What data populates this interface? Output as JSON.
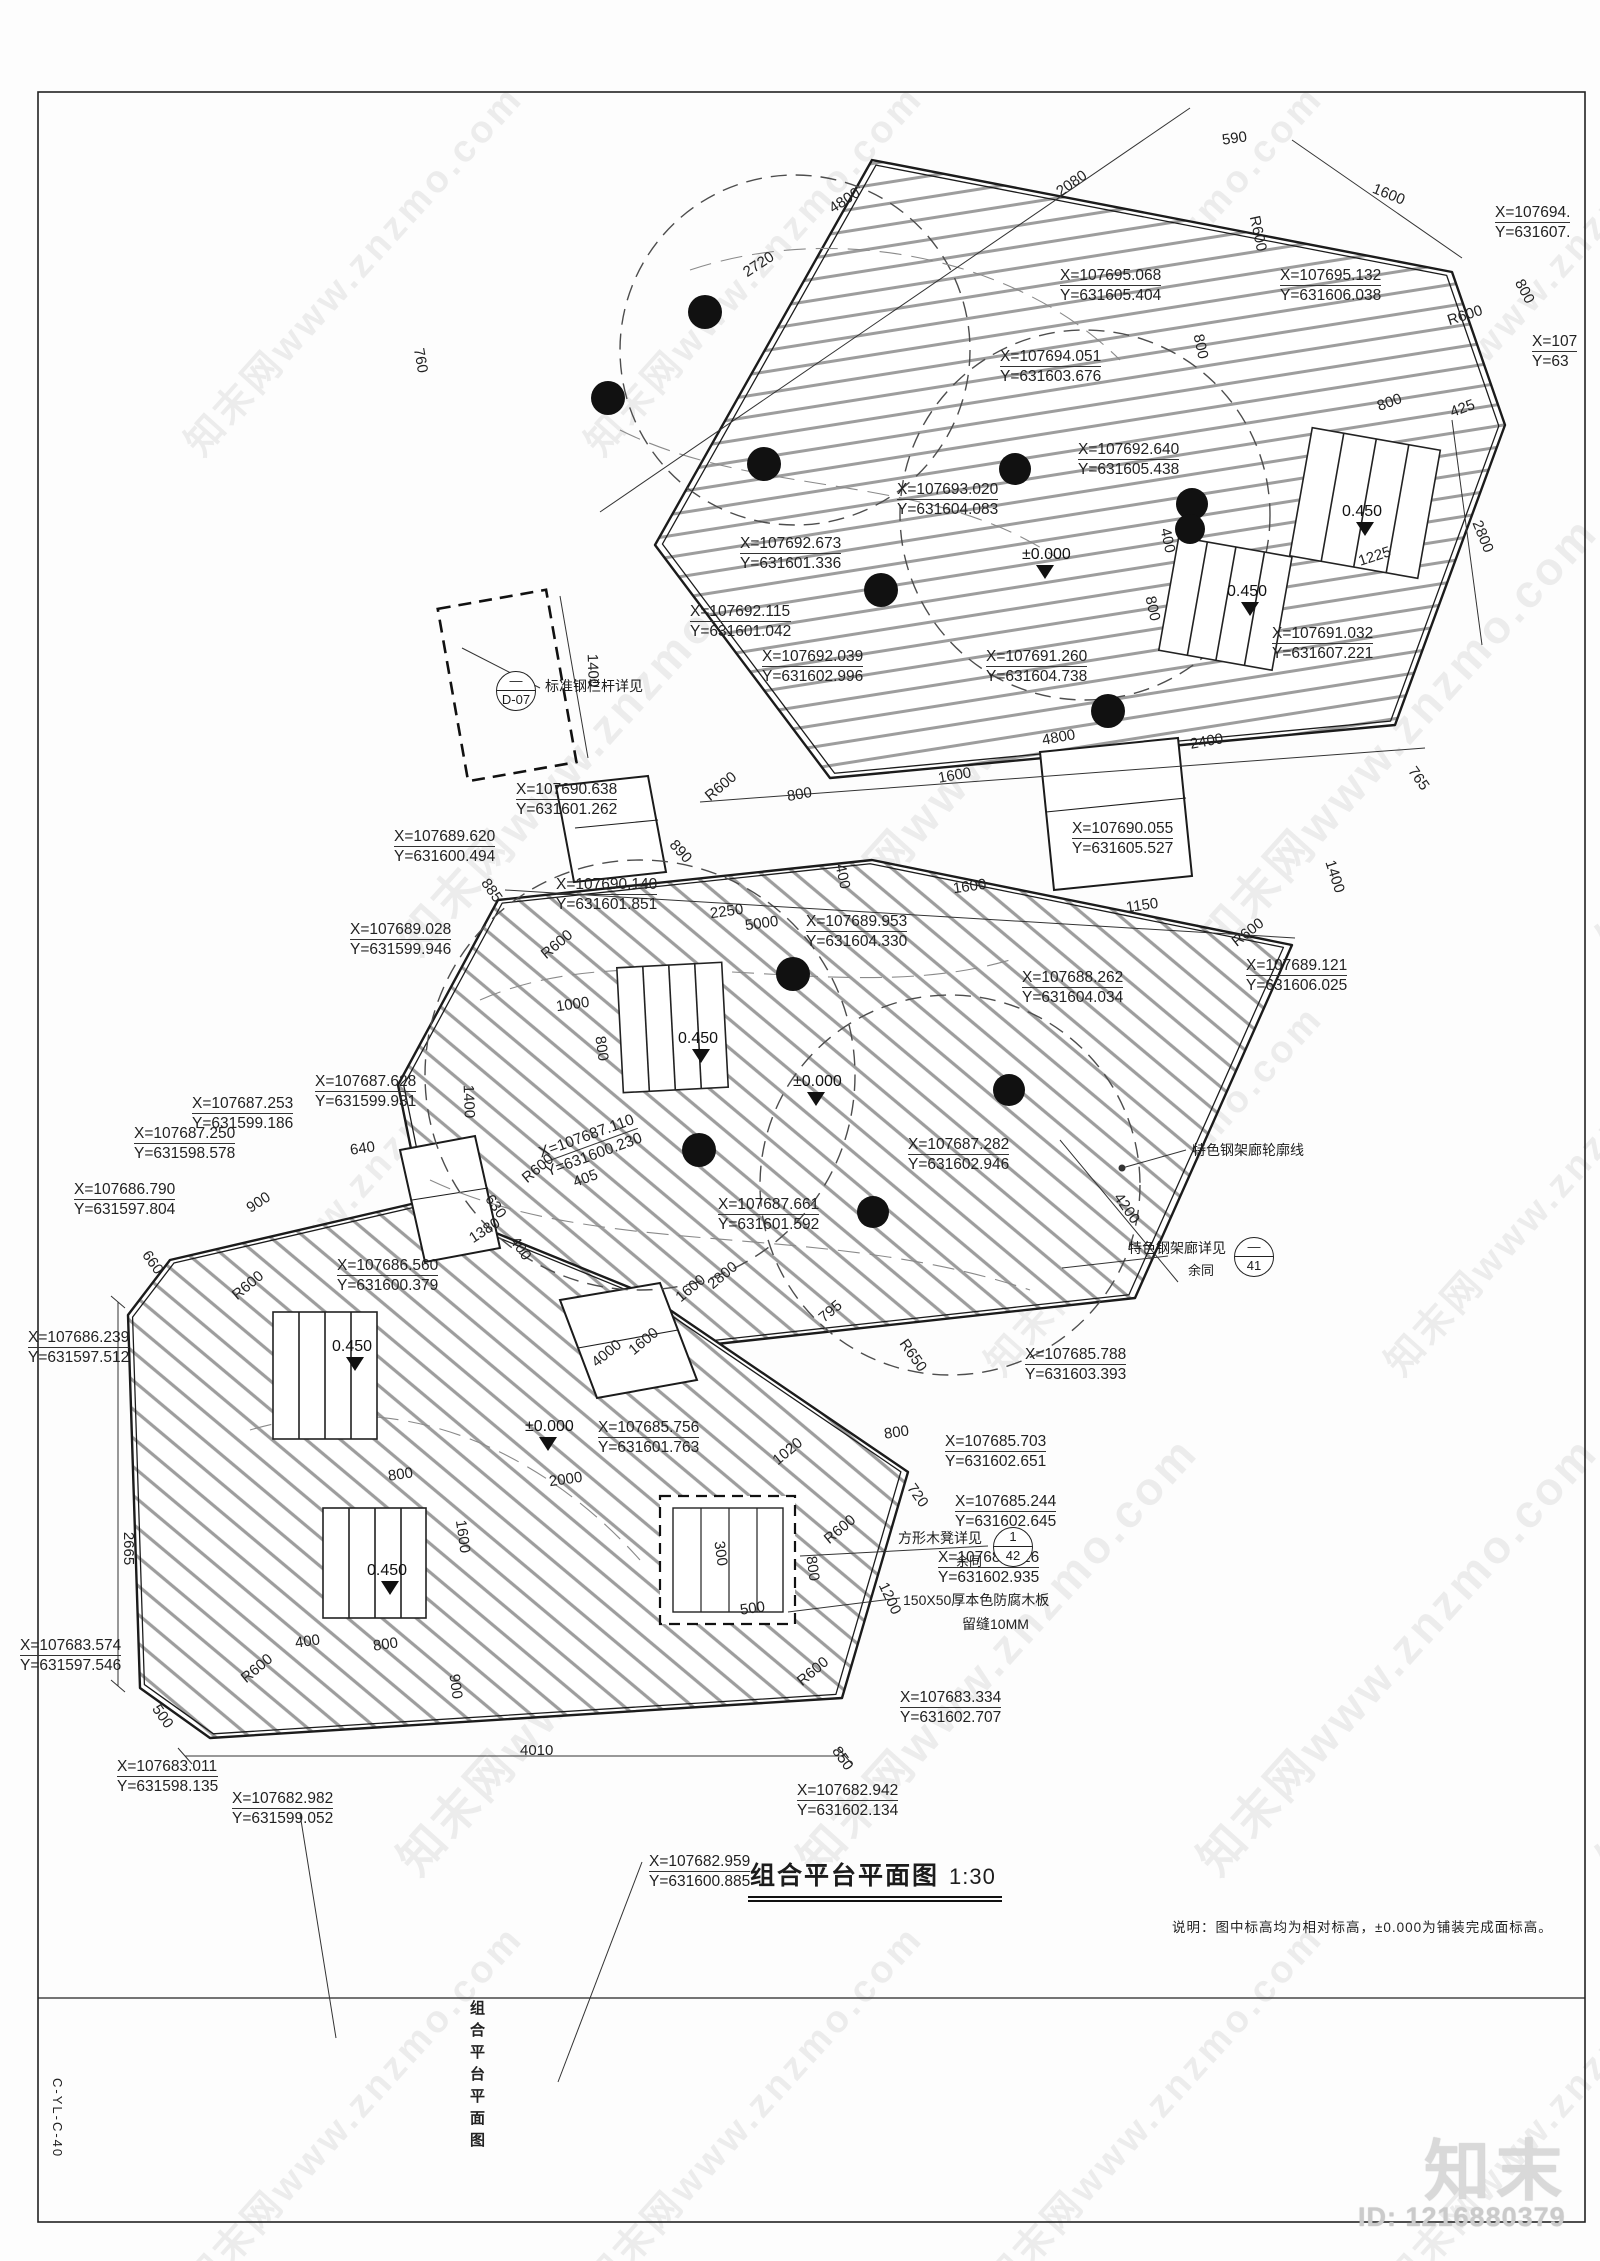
{
  "sheet": {
    "drawing_title": "组合平台平面图",
    "drawing_scale": "1:30",
    "side_title": "组合平台平面图",
    "sheet_number": "C-YL-C-40",
    "note": "说明：图中标高均为相对标高，±0.000为铺装完成面标高。"
  },
  "watermark": {
    "brand": "知末",
    "tile_text": "知末网www.znzmo.com",
    "id_text": "ID: 1216880379"
  },
  "annotations": {
    "coordinates": [
      {
        "xt": "X=107695.068",
        "yt": "Y=631605.404",
        "x": 1060,
        "y": 266
      },
      {
        "xt": "X=107695.132",
        "yt": "Y=631606.038",
        "x": 1280,
        "y": 266
      },
      {
        "xt": "X=107694.",
        "yt": "Y=631607.",
        "x": 1495,
        "y": 203
      },
      {
        "xt": "X=107694.051",
        "yt": "Y=631603.676",
        "x": 1000,
        "y": 347
      },
      {
        "xt": "X=107692.640",
        "yt": "Y=631605.438",
        "x": 1078,
        "y": 440
      },
      {
        "xt": "X=107693.020",
        "yt": "Y=631604.083",
        "x": 897,
        "y": 480
      },
      {
        "xt": "X=107692.673",
        "yt": "Y=631601.336",
        "x": 740,
        "y": 534
      },
      {
        "xt": "X=107",
        "yt": "Y=63",
        "x": 1532,
        "y": 332
      },
      {
        "xt": "X=107692.115",
        "yt": "Y=631601.042",
        "x": 690,
        "y": 602
      },
      {
        "xt": "X=107692.039",
        "yt": "Y=631602.996",
        "x": 762,
        "y": 647
      },
      {
        "xt": "X=107691.260",
        "yt": "Y=631604.738",
        "x": 986,
        "y": 647
      },
      {
        "xt": "X=107691.032",
        "yt": "Y=631607.221",
        "x": 1272,
        "y": 624
      },
      {
        "xt": "X=107690.638",
        "yt": "Y=631601.262",
        "x": 516,
        "y": 780
      },
      {
        "xt": "X=107689.620",
        "yt": "Y=631600.494",
        "x": 394,
        "y": 827
      },
      {
        "xt": "X=107690.140",
        "yt": "Y=631601.851",
        "x": 556,
        "y": 875
      },
      {
        "xt": "X=107690.055",
        "yt": "Y=631605.527",
        "x": 1072,
        "y": 819
      },
      {
        "xt": "X=107689.028",
        "yt": "Y=631599.946",
        "x": 350,
        "y": 920
      },
      {
        "xt": "X=107689.953",
        "yt": "Y=631604.330",
        "x": 806,
        "y": 912
      },
      {
        "xt": "X=107688.262",
        "yt": "Y=631604.034",
        "x": 1022,
        "y": 968
      },
      {
        "xt": "X=107689.121",
        "yt": "Y=631606.025",
        "x": 1246,
        "y": 956
      },
      {
        "xt": "X=107687.628",
        "yt": "Y=631599.931",
        "x": 315,
        "y": 1072
      },
      {
        "xt": "X=107687.253",
        "yt": "Y=631599.186",
        "x": 192,
        "y": 1094
      },
      {
        "xt": "X=107687.250",
        "yt": "Y=631598.578",
        "x": 134,
        "y": 1124
      },
      {
        "xt": "X=107686.790",
        "yt": "Y=631597.804",
        "x": 74,
        "y": 1180
      },
      {
        "xt": "X=107687.110",
        "yt": "Y=631600.230",
        "x": 540,
        "y": 1126,
        "r": -20
      },
      {
        "xt": "X=107687.282",
        "yt": "Y=631602.946",
        "x": 908,
        "y": 1135
      },
      {
        "xt": "X=107687.661",
        "yt": "Y=631601.592",
        "x": 718,
        "y": 1195
      },
      {
        "xt": "X=107686.560",
        "yt": "Y=631600.379",
        "x": 337,
        "y": 1256
      },
      {
        "xt": "X=107686.239",
        "yt": "Y=631597.512",
        "x": 28,
        "y": 1328
      },
      {
        "xt": "X=107685.756",
        "yt": "Y=631601.763",
        "x": 598,
        "y": 1418
      },
      {
        "xt": "X=107685.788",
        "yt": "Y=631603.393",
        "x": 1025,
        "y": 1345
      },
      {
        "xt": "X=107685.703",
        "yt": "Y=631602.651",
        "x": 945,
        "y": 1432
      },
      {
        "xt": "X=107685.244",
        "yt": "Y=631602.645",
        "x": 955,
        "y": 1492
      },
      {
        "xt": "X=107684.626",
        "yt": "Y=631602.935",
        "x": 938,
        "y": 1548
      },
      {
        "xt": "X=107683.574",
        "yt": "Y=631597.546",
        "x": 20,
        "y": 1636
      },
      {
        "xt": "X=107683.334",
        "yt": "Y=631602.707",
        "x": 900,
        "y": 1688
      },
      {
        "xt": "X=107682.942",
        "yt": "Y=631602.134",
        "x": 797,
        "y": 1781
      },
      {
        "xt": "X=107682.959",
        "yt": "Y=631600.885",
        "x": 649,
        "y": 1852
      },
      {
        "xt": "X=107683.011",
        "yt": "Y=631598.135",
        "x": 117,
        "y": 1757
      },
      {
        "xt": "X=107682.982",
        "yt": "Y=631599.052",
        "x": 232,
        "y": 1789
      }
    ],
    "dimensions": [
      [
        "2720",
        742,
        256,
        -33
      ],
      [
        "4800",
        828,
        192,
        -33
      ],
      [
        "2080",
        1055,
        175,
        -35
      ],
      [
        "590",
        1222,
        130,
        -8
      ],
      [
        "1600",
        1372,
        186,
        22
      ],
      [
        "800",
        1512,
        283,
        62
      ],
      [
        "R600",
        1447,
        307,
        -18
      ],
      [
        "425",
        1450,
        400,
        -20
      ],
      [
        "800",
        1377,
        394,
        -20
      ],
      [
        "R600",
        1240,
        225,
        78
      ],
      [
        "760",
        408,
        352,
        80
      ],
      [
        "800",
        1188,
        338,
        78
      ],
      [
        "400",
        1155,
        532,
        78
      ],
      [
        "800",
        1140,
        600,
        78
      ],
      [
        "1225",
        1358,
        548,
        -18
      ],
      [
        "2800",
        1466,
        528,
        68
      ],
      [
        "1400",
        576,
        662,
        88
      ],
      [
        "2400",
        1190,
        733,
        -10
      ],
      [
        "4800",
        1042,
        729,
        -10
      ],
      [
        "765",
        1406,
        770,
        55
      ],
      [
        "1400",
        1318,
        868,
        72
      ],
      [
        "1150",
        1126,
        897,
        -8
      ],
      [
        "R600",
        1230,
        924,
        -38
      ],
      [
        "800",
        787,
        786,
        -10
      ],
      [
        "1600",
        938,
        767,
        -10
      ],
      [
        "R600",
        703,
        778,
        -40
      ],
      [
        "890",
        668,
        843,
        48
      ],
      [
        "400",
        830,
        868,
        78
      ],
      [
        "885",
        479,
        882,
        55
      ],
      [
        "2250",
        710,
        903,
        -8
      ],
      [
        "1600",
        953,
        878,
        -8
      ],
      [
        "5000",
        745,
        915,
        -8
      ],
      [
        "R600",
        539,
        936,
        -40
      ],
      [
        "1000",
        556,
        996,
        -8
      ],
      [
        "800",
        589,
        1040,
        82
      ],
      [
        "1400",
        452,
        1093,
        88
      ],
      [
        "R600",
        520,
        1160,
        -40
      ],
      [
        "405",
        573,
        1170,
        -20
      ],
      [
        "630",
        483,
        1198,
        55
      ],
      [
        "640",
        350,
        1140,
        -8
      ],
      [
        "900",
        246,
        1194,
        -33
      ],
      [
        "660",
        140,
        1254,
        55
      ],
      [
        "1380",
        468,
        1222,
        -33
      ],
      [
        "400",
        508,
        1240,
        55
      ],
      [
        "4200",
        1110,
        1200,
        55
      ],
      [
        "2800",
        706,
        1267,
        -40
      ],
      [
        "1600",
        674,
        1280,
        -40
      ],
      [
        "4000",
        590,
        1345,
        -40
      ],
      [
        "1600",
        627,
        1333,
        -40
      ],
      [
        "795",
        818,
        1303,
        -40
      ],
      [
        "R650",
        895,
        1347,
        55
      ],
      [
        "800",
        884,
        1424,
        -8
      ],
      [
        "1020",
        771,
        1443,
        -40
      ],
      [
        "720",
        905,
        1487,
        55
      ],
      [
        "R600",
        822,
        1521,
        -40
      ],
      [
        "R600",
        230,
        1277,
        -40
      ],
      [
        "2665",
        112,
        1540,
        90
      ],
      [
        "800",
        388,
        1466,
        -8
      ],
      [
        "2000",
        549,
        1471,
        -8
      ],
      [
        "1600",
        446,
        1528,
        82
      ],
      [
        "400",
        295,
        1633,
        -8
      ],
      [
        "800",
        373,
        1636,
        -8
      ],
      [
        "900",
        443,
        1678,
        82
      ],
      [
        "R600",
        239,
        1660,
        -40
      ],
      [
        "500",
        150,
        1708,
        55
      ],
      [
        "4010",
        520,
        1742,
        0
      ],
      [
        "R600",
        795,
        1663,
        -40
      ],
      [
        "850",
        830,
        1750,
        55
      ],
      [
        "1200",
        873,
        1590,
        65
      ],
      [
        "300",
        708,
        1545,
        82
      ],
      [
        "500",
        740,
        1600,
        -8
      ],
      [
        "800",
        800,
        1560,
        82
      ]
    ],
    "levels": [
      [
        "±0.000",
        1022,
        546
      ],
      [
        "±0.000",
        793,
        1073
      ],
      [
        "±0.000",
        525,
        1418
      ],
      [
        "0.450",
        1342,
        503
      ],
      [
        "0.450",
        1227,
        583
      ],
      [
        "0.450",
        678,
        1030
      ],
      [
        "0.450",
        332,
        1338
      ],
      [
        "0.450",
        367,
        1562
      ]
    ],
    "callouts": [
      {
        "top": "—",
        "bottom": "D-07",
        "cx": 515,
        "cy": 690,
        "label": "标准钢栏杆详见",
        "lx": 545,
        "ly": 676,
        "sub": "",
        "sx": 0,
        "sy": 0
      },
      {
        "top": "—",
        "bottom": "41",
        "cx": 1253,
        "cy": 1256,
        "label": "特色钢架廊详见",
        "lx": 1128,
        "ly": 1238,
        "sub": "余同",
        "sx": 1188,
        "sy": 1260
      },
      {
        "top": "1",
        "bottom": "42",
        "cx": 1012,
        "cy": 1546,
        "label": "方形木凳详见",
        "lx": 898,
        "ly": 1528,
        "sub": "余同",
        "sx": 956,
        "sy": 1551
      }
    ],
    "notes": [
      {
        "text": "特色钢架廊轮廓线",
        "x": 1192,
        "y": 1140
      },
      {
        "text": "150X50厚本色防腐木板",
        "x": 903,
        "y": 1590
      },
      {
        "text": "留缝10MM",
        "x": 962,
        "y": 1614
      }
    ]
  }
}
